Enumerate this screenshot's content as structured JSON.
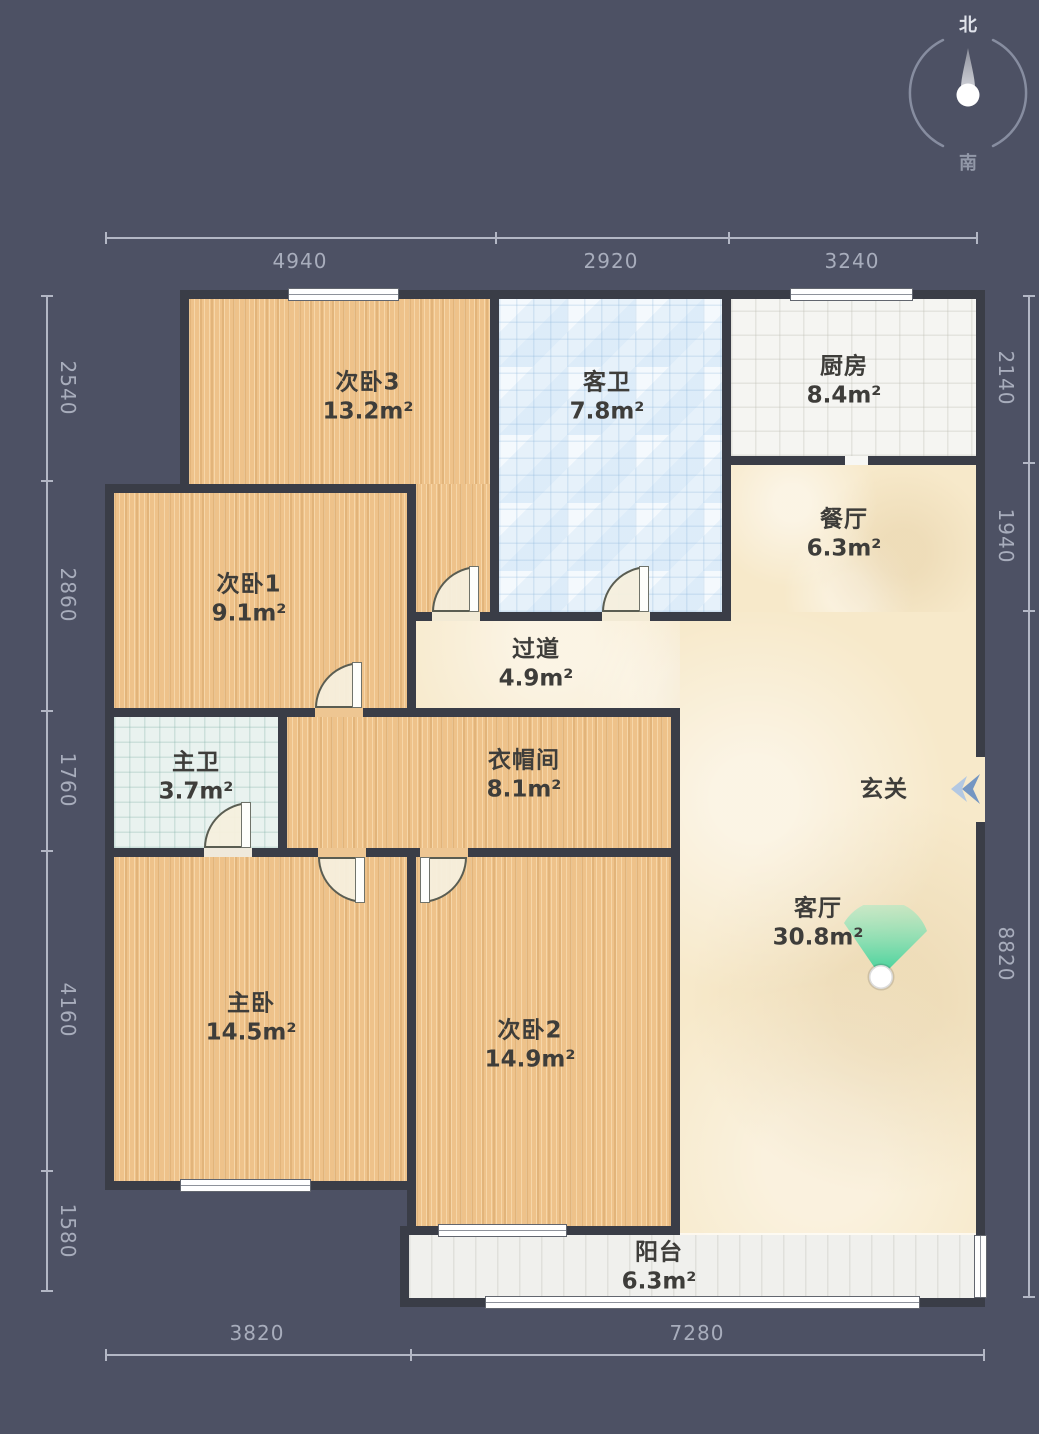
{
  "compass": {
    "north": "北",
    "south": "南"
  },
  "rooms": {
    "bedroom3": {
      "name": "次卧3",
      "area": "13.2m²"
    },
    "guest_bath": {
      "name": "客卫",
      "area": "7.8m²"
    },
    "kitchen": {
      "name": "厨房",
      "area": "8.4m²"
    },
    "dining": {
      "name": "餐厅",
      "area": "6.3m²"
    },
    "bedroom1": {
      "name": "次卧1",
      "area": "9.1m²"
    },
    "hallway": {
      "name": "过道",
      "area": "4.9m²"
    },
    "master_bath": {
      "name": "主卫",
      "area": "3.7m²"
    },
    "closet": {
      "name": "衣帽间",
      "area": "8.1m²"
    },
    "entry": {
      "name": "玄关"
    },
    "living": {
      "name": "客厅",
      "area": "30.8m²"
    },
    "master_bedroom": {
      "name": "主卧",
      "area": "14.5m²"
    },
    "bedroom2": {
      "name": "次卧2",
      "area": "14.9m²"
    },
    "balcony": {
      "name": "阳台",
      "area": "6.3m²"
    }
  },
  "dimensions": {
    "top": [
      "4940",
      "2920",
      "3240"
    ],
    "left": [
      "2540",
      "2860",
      "1760",
      "4160",
      "1580"
    ],
    "right": [
      "2140",
      "1940",
      "8820"
    ],
    "bottom": [
      "3820",
      "7280"
    ]
  },
  "colors": {
    "background": "#4d5164",
    "wall": "#3a3d47",
    "wood": "#eec28a",
    "tile_blue": "#e6f1fa",
    "tile_teal": "#e9f2ef",
    "tile_white": "#f5f5f2",
    "marble": "#f7e9ca",
    "balcony_floor": "#f0f0ed",
    "fan_green": "#2fcf96",
    "arrow_blue": "#7596c2",
    "dim_gray": "#b3b7c5"
  }
}
